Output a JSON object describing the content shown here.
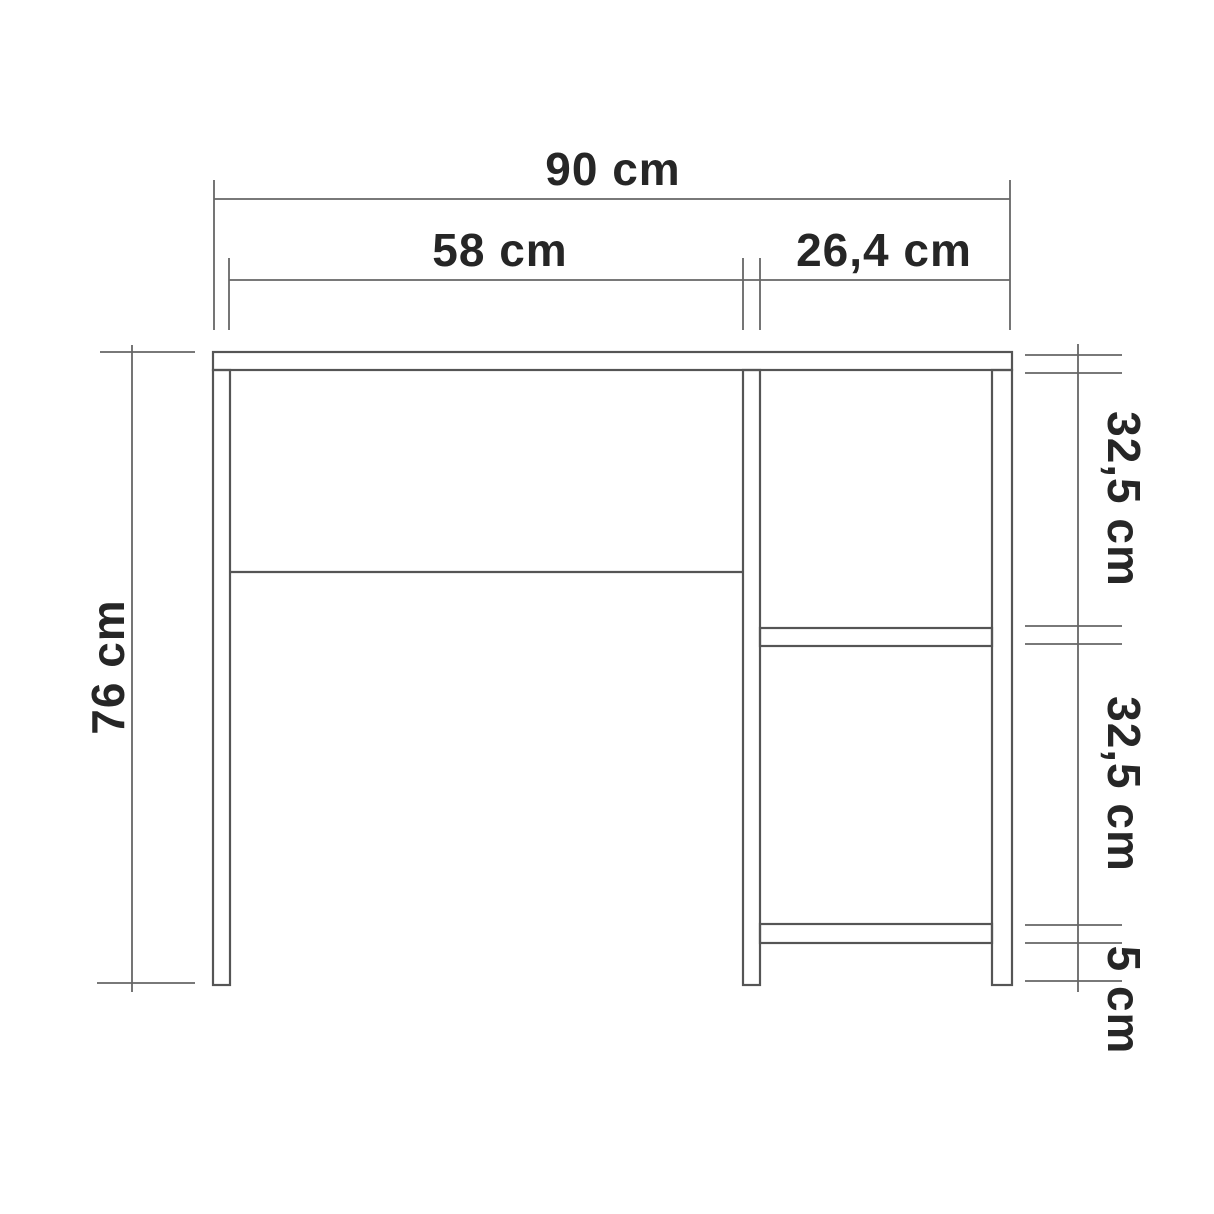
{
  "drawing": {
    "view": "front elevation technical drawing",
    "subject": "desk with right-hand shelf column",
    "background_color": "#ffffff",
    "structure_line_color": "#555555",
    "dimension_line_color": "#666666",
    "text_color": "#262626"
  },
  "dimensions": {
    "total_width": {
      "label": "90 cm",
      "value_cm": 90,
      "orientation": "horizontal"
    },
    "desk_bay_width": {
      "label": "58 cm",
      "value_cm": 58,
      "orientation": "horizontal"
    },
    "shelf_bay_width": {
      "label": "26,4 cm",
      "value_cm": 26.4,
      "orientation": "horizontal"
    },
    "total_height": {
      "label": "76 cm",
      "value_cm": 76,
      "orientation": "vertical"
    },
    "upper_shelf_spacing": {
      "label": "32,5 cm",
      "value_cm": 32.5,
      "orientation": "vertical"
    },
    "lower_shelf_spacing": {
      "label": "32,5 cm",
      "value_cm": 32.5,
      "orientation": "vertical"
    },
    "bottom_clearance": {
      "label": "5 cm",
      "value_cm": 5,
      "orientation": "vertical"
    }
  }
}
